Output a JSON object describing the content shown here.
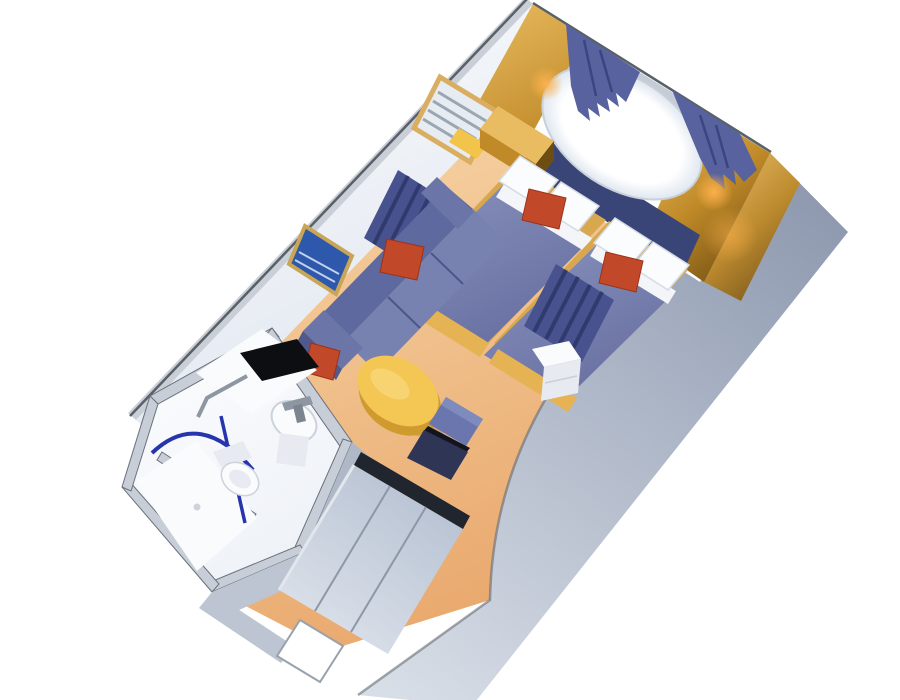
{
  "scene": {
    "description": "3D isometric cutaway rendering of a cruise ship stateroom floor plan, rotated diagonally on a white background",
    "view": "top-down oblique cutaway, no ceiling",
    "background": "#ffffff"
  },
  "palette": {
    "background": "#ffffff",
    "floor_light": "#f8d8ab",
    "floor_dark": "#e9a96e",
    "wall_white": "#fdfdfe",
    "wall_shadow": "#dfe6ef",
    "wall_top_edge": "#c9ced7",
    "wall_edge_line": "#596067",
    "back_top_band": "#c5ccd6",
    "right_wall_top": "#8f9ab0",
    "right_wall_bottom": "#d8dee7",
    "gold_light": "#e9bc62",
    "gold_mid": "#c08a28",
    "gold_dark": "#6e4d12",
    "wood_gold": "#d9a84e",
    "wood_gold_bright": "#e5b254",
    "headboard_navy": "#3a4577",
    "curtain_blue": "#57629e",
    "curtain_fold": "#3b4680",
    "divider_blue": "#47528f",
    "divider_fold": "#303a6e",
    "blanket_light": "#8a93bd",
    "blanket_dark": "#666fa0",
    "pillow_white": "#fbfcfd",
    "pillow_edge": "#d5dbe4",
    "sheet_white": "#f3f5f8",
    "accent_red": "#c14829",
    "accent_red_edge": "#9d3218",
    "sofa_back": "#5e699f",
    "sofa_seat": "#7882b1",
    "sofa_arm": "#6b75a7",
    "sofa_arm_shadow": "#4f598c",
    "sofa_seam": "#4d5787",
    "table_top": "#f4c654",
    "table_side": "#cf9a2e",
    "table_highlight": "#f9d97e",
    "chair_blue": "#6a76ad",
    "chair_blue_light": "#7f8abd",
    "chair_seat_dark": "#2e3555",
    "chair_shadow": "#12151f",
    "bathroom_wall": "#c8ced8",
    "bathroom_wall_line": "#6a717b",
    "bathroom_floor": "#eef2f8",
    "corridor_wall": "#aeb8c6",
    "corridor_wall_light": "#bcc5d1",
    "fixture_white": "#fafbfd",
    "fixture_shadow": "#e7ebf1",
    "fixture_edge": "#ccd3dc",
    "counter_black": "#0d0e12",
    "chrome": "#8e96a1",
    "chrome_dark": "#7c848f",
    "shower_rod_blue": "#2735ad",
    "closet_door_light": "#e2e7ee",
    "closet_door_dark": "#b6c1d2",
    "closet_rail": "#20252e",
    "closet_seam": "#8d97a6",
    "sconce_glow": "#ffb24d",
    "window_white": "#ffffff",
    "window_edge": "#dfe7f0",
    "window_frame": "#c9d0da",
    "picture_blue": "#2e58ab",
    "picture_streak": "#d8e6f6",
    "frame_gold": "#c9a556",
    "blinds_bg": "#e7ecf2",
    "blinds_slat": "#9aa6b2",
    "blinds_frame": "#d9ae62",
    "blinds_yellow": "#f2c54a",
    "shadow": "#000000"
  },
  "rooms": {
    "sleeping_area": {
      "label": "Sleeping area",
      "items": [
        "twin-bed-left",
        "twin-bed-right",
        "nightstand",
        "upholstered-headboard",
        "picture-window",
        "window-curtain-left",
        "window-curtain-right",
        "wall-sconce-left",
        "wall-sconce-right",
        "mirror-with-blinds",
        "white-cabinet"
      ]
    },
    "sitting_area": {
      "label": "Sitting area",
      "items": [
        "sofa",
        "red-accent-pillows",
        "coffee-table",
        "framed-wall-art",
        "desk-chair",
        "divider-curtain-left",
        "divider-curtain-right"
      ]
    },
    "bathroom": {
      "label": "Bathroom",
      "items": [
        "vanity-counter",
        "sink",
        "faucet",
        "toilet",
        "towel-bar",
        "shower-stall",
        "shower-curtain-rod"
      ]
    },
    "entry": {
      "label": "Entry corridor",
      "items": [
        "closet-sliding-doors",
        "entry-door"
      ]
    }
  }
}
